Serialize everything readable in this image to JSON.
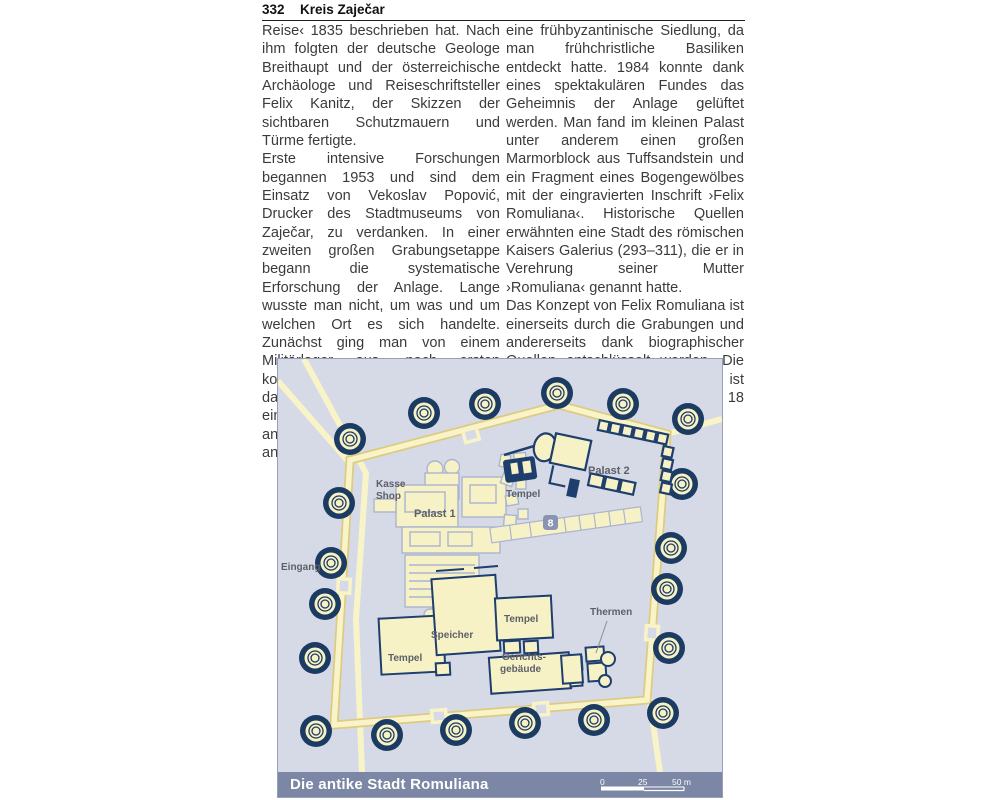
{
  "header": {
    "page_number": "332",
    "title": "Kreis Zaječar"
  },
  "article": {
    "left_column": [
      "Reise‹ 1835 beschrieben hat. Nach ihm folgten der deutsche Geologe Breithaupt und der österreichische Archäologe und Reiseschriftsteller Felix Kanitz, der Skizzen der sichtbaren Schutzmauern und Türme fertigte.",
      "Erste intensive Forschungen begannen 1953 und sind dem Einsatz von Vekoslav Popović, Drucker des Stadtmuseums von Zaječar, zu verdanken. In einer zweiten großen Grabungsetappe begann die systematische Erforschung der Anlage. Lange wusste man nicht, um was und um welchen Ort es sich handelte. Zunächst ging man von einem Militärlager aus, nach ersten kostbaren Funden – den Mosaiken – dachte man an eine luxuriöse Villa, einen prunkvollen Landsitz oder gar an einen Bischofssitz und schließlich an"
    ],
    "right_column": [
      "eine frühbyzantinische Siedlung, da man frühchristliche Basiliken entdeckt hatte. 1984 konnte dank eines spektakulären Fundes das Geheimnis der Anlage gelüftet werden. Man fand im kleinen Palast unter anderem einen großen Marmorblock aus Tuffsandstein und ein Fragment eines Bogengewölbes mit der eingravierten Inschrift ›Felix Romuliana‹. Historische Quellen erwähnten eine Stadt des römischen Kaisers Galerius (293–311), die er in Verehrung seiner Mutter ›Romuliana‹ genannt hatte.",
      "Das Konzept von Felix Romuliana ist einerseits durch die Grabungen und andererseits dank biographischer Quellen entschlüsselt worden. Die Ausgrabungsstätte Gamzigrad ist täglich, außer montags, von 8 bis 18 Uhr geöffnet."
    ]
  },
  "map": {
    "caption": "Die antike Stadt Romuliana",
    "scale_labels": {
      "start": "0",
      "mid": "25",
      "end": "50 m"
    },
    "labels": {
      "eingang": "Eingang",
      "kasse": "Kasse",
      "shop": "Shop",
      "palast1": "Palast 1",
      "tempel_nord": "Tempel",
      "palast2": "Palast 2",
      "marker8": "8",
      "tempel_west": "Tempel",
      "speicher": "Speicher",
      "tempel_mitte": "Tempel",
      "gerichts_line1": "Gerichts-",
      "gerichts_line2": "gebäude",
      "thermen": "Thermen"
    },
    "colors": {
      "background": "#d6dae7",
      "wall_fill": "#f9f3c8",
      "wall_edge": "#ddcb81",
      "tower": "#1c3b63",
      "building_outline_light": "#aab5d0",
      "building_outline_dark": "#1e3f6e",
      "label_text": "#5c6068",
      "caption_bar": "#7b87a5",
      "caption_text": "#ffffff",
      "marker_badge": "#8a94b2"
    }
  }
}
